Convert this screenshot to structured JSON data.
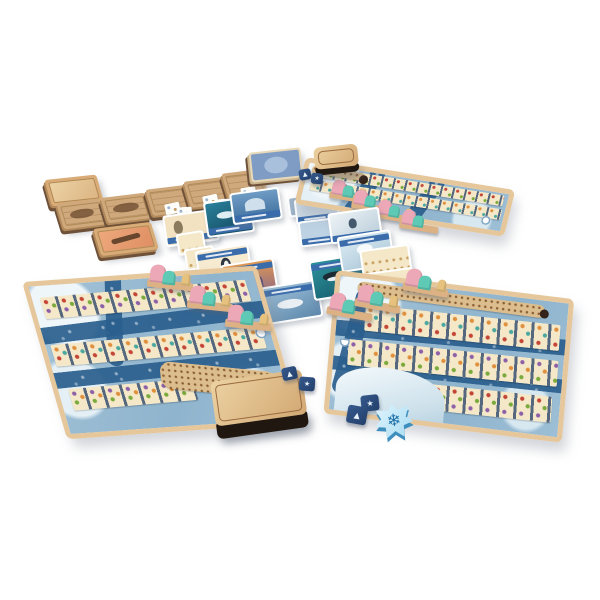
{
  "scene": {
    "description": "Product photo: tabletop spread of an arctic sled-animals board game on a white background — three tilted player boards with card tracks and rivers, a market of wooden tiles and cards, pink and teal animal standees on wooden sleds, blue engraved dice, a snowflake token and wooden paw-print boxes.",
    "background": "#ffffff"
  },
  "palette": {
    "wood": "#d9ac77",
    "wood_dark": "#1f1710",
    "kraft": "#cfa97c",
    "card_cream": "#f4e8c8",
    "slot_gray": "#55677e",
    "board_water": "#8fb4cd",
    "river": "#2b5f8e",
    "board_frame": "#e6c79b",
    "banner_blue": "#3a6cab",
    "die_blue": "#2b4d7e",
    "standee_pink": "#eca8b6",
    "standee_teal": "#5ecab5",
    "standee_cream": "#e6c27e",
    "snow_token_face": "#a8dcf2",
    "icon_red": "#c44536",
    "icon_orange": "#e08f3c",
    "icon_green": "#7aa93c",
    "icon_purple": "#8d5fa8"
  },
  "icons": {
    "snowflake_glyph": "❄",
    "die_arrow_glyph": "▲",
    "die_star_glyph": "★"
  },
  "components": {
    "paw_tile_stack": {
      "label": "stack of square wooden tiles with paw print"
    },
    "animal_tile_a": {
      "label": "wooden tile with engraved animal art"
    },
    "animal_tile_b": {
      "label": "wooden tile with engraved animal art"
    },
    "feather_tile": {
      "label": "wooden tile with orange feather art"
    },
    "market_tiles": {
      "label": "three kraft market tiles with fanned mini cards"
    },
    "card_deck": {
      "label": "blue-backed card deck with oval emblem"
    },
    "penguin_card_upper": {
      "label": "cream penguin card"
    },
    "whale_card_upper": {
      "label": "teal whale card"
    },
    "mountain_card_upper": {
      "label": "blue mountain card"
    },
    "gray_card_stack": {
      "label": "gray card stack"
    },
    "ice_cards": {
      "label": "pale ice-scene cards"
    },
    "dolphin_card": {
      "label": "white orca-fin card"
    },
    "penguin_card_mid": {
      "label": "penguin card with blue banner"
    },
    "sunset_card": {
      "label": "sunset mountain card with blue banner"
    },
    "seal_card": {
      "label": "sleeping seal card with blue banner"
    },
    "orca_card": {
      "label": "teal orca card with blue banner"
    },
    "polar_bear_card": {
      "label": "pale polar bear card with blue banner"
    },
    "reference_cards": {
      "label": "cream reference cards with icon rows"
    },
    "top_player_board": {
      "label": "player board, top right, with card tracks, rivers and sled standees"
    },
    "left_player_board": {
      "label": "player board, bottom left, with card tracks, rivers and bear-shaped score track"
    },
    "right_player_board": {
      "label": "player board, bottom right, with card tracks, rivers and ice mountain"
    },
    "sled_standees": {
      "label": "pink and teal animal standees on wooden sleds"
    },
    "paw_box_large": {
      "label": "deep wooden box with paw-print lid"
    },
    "paw_box_lid": {
      "label": "small wooden paw-print box"
    },
    "dice": {
      "label": "dark blue engraved dice"
    },
    "snowflake_token": {
      "label": "light blue snowflake-shaped token"
    }
  }
}
